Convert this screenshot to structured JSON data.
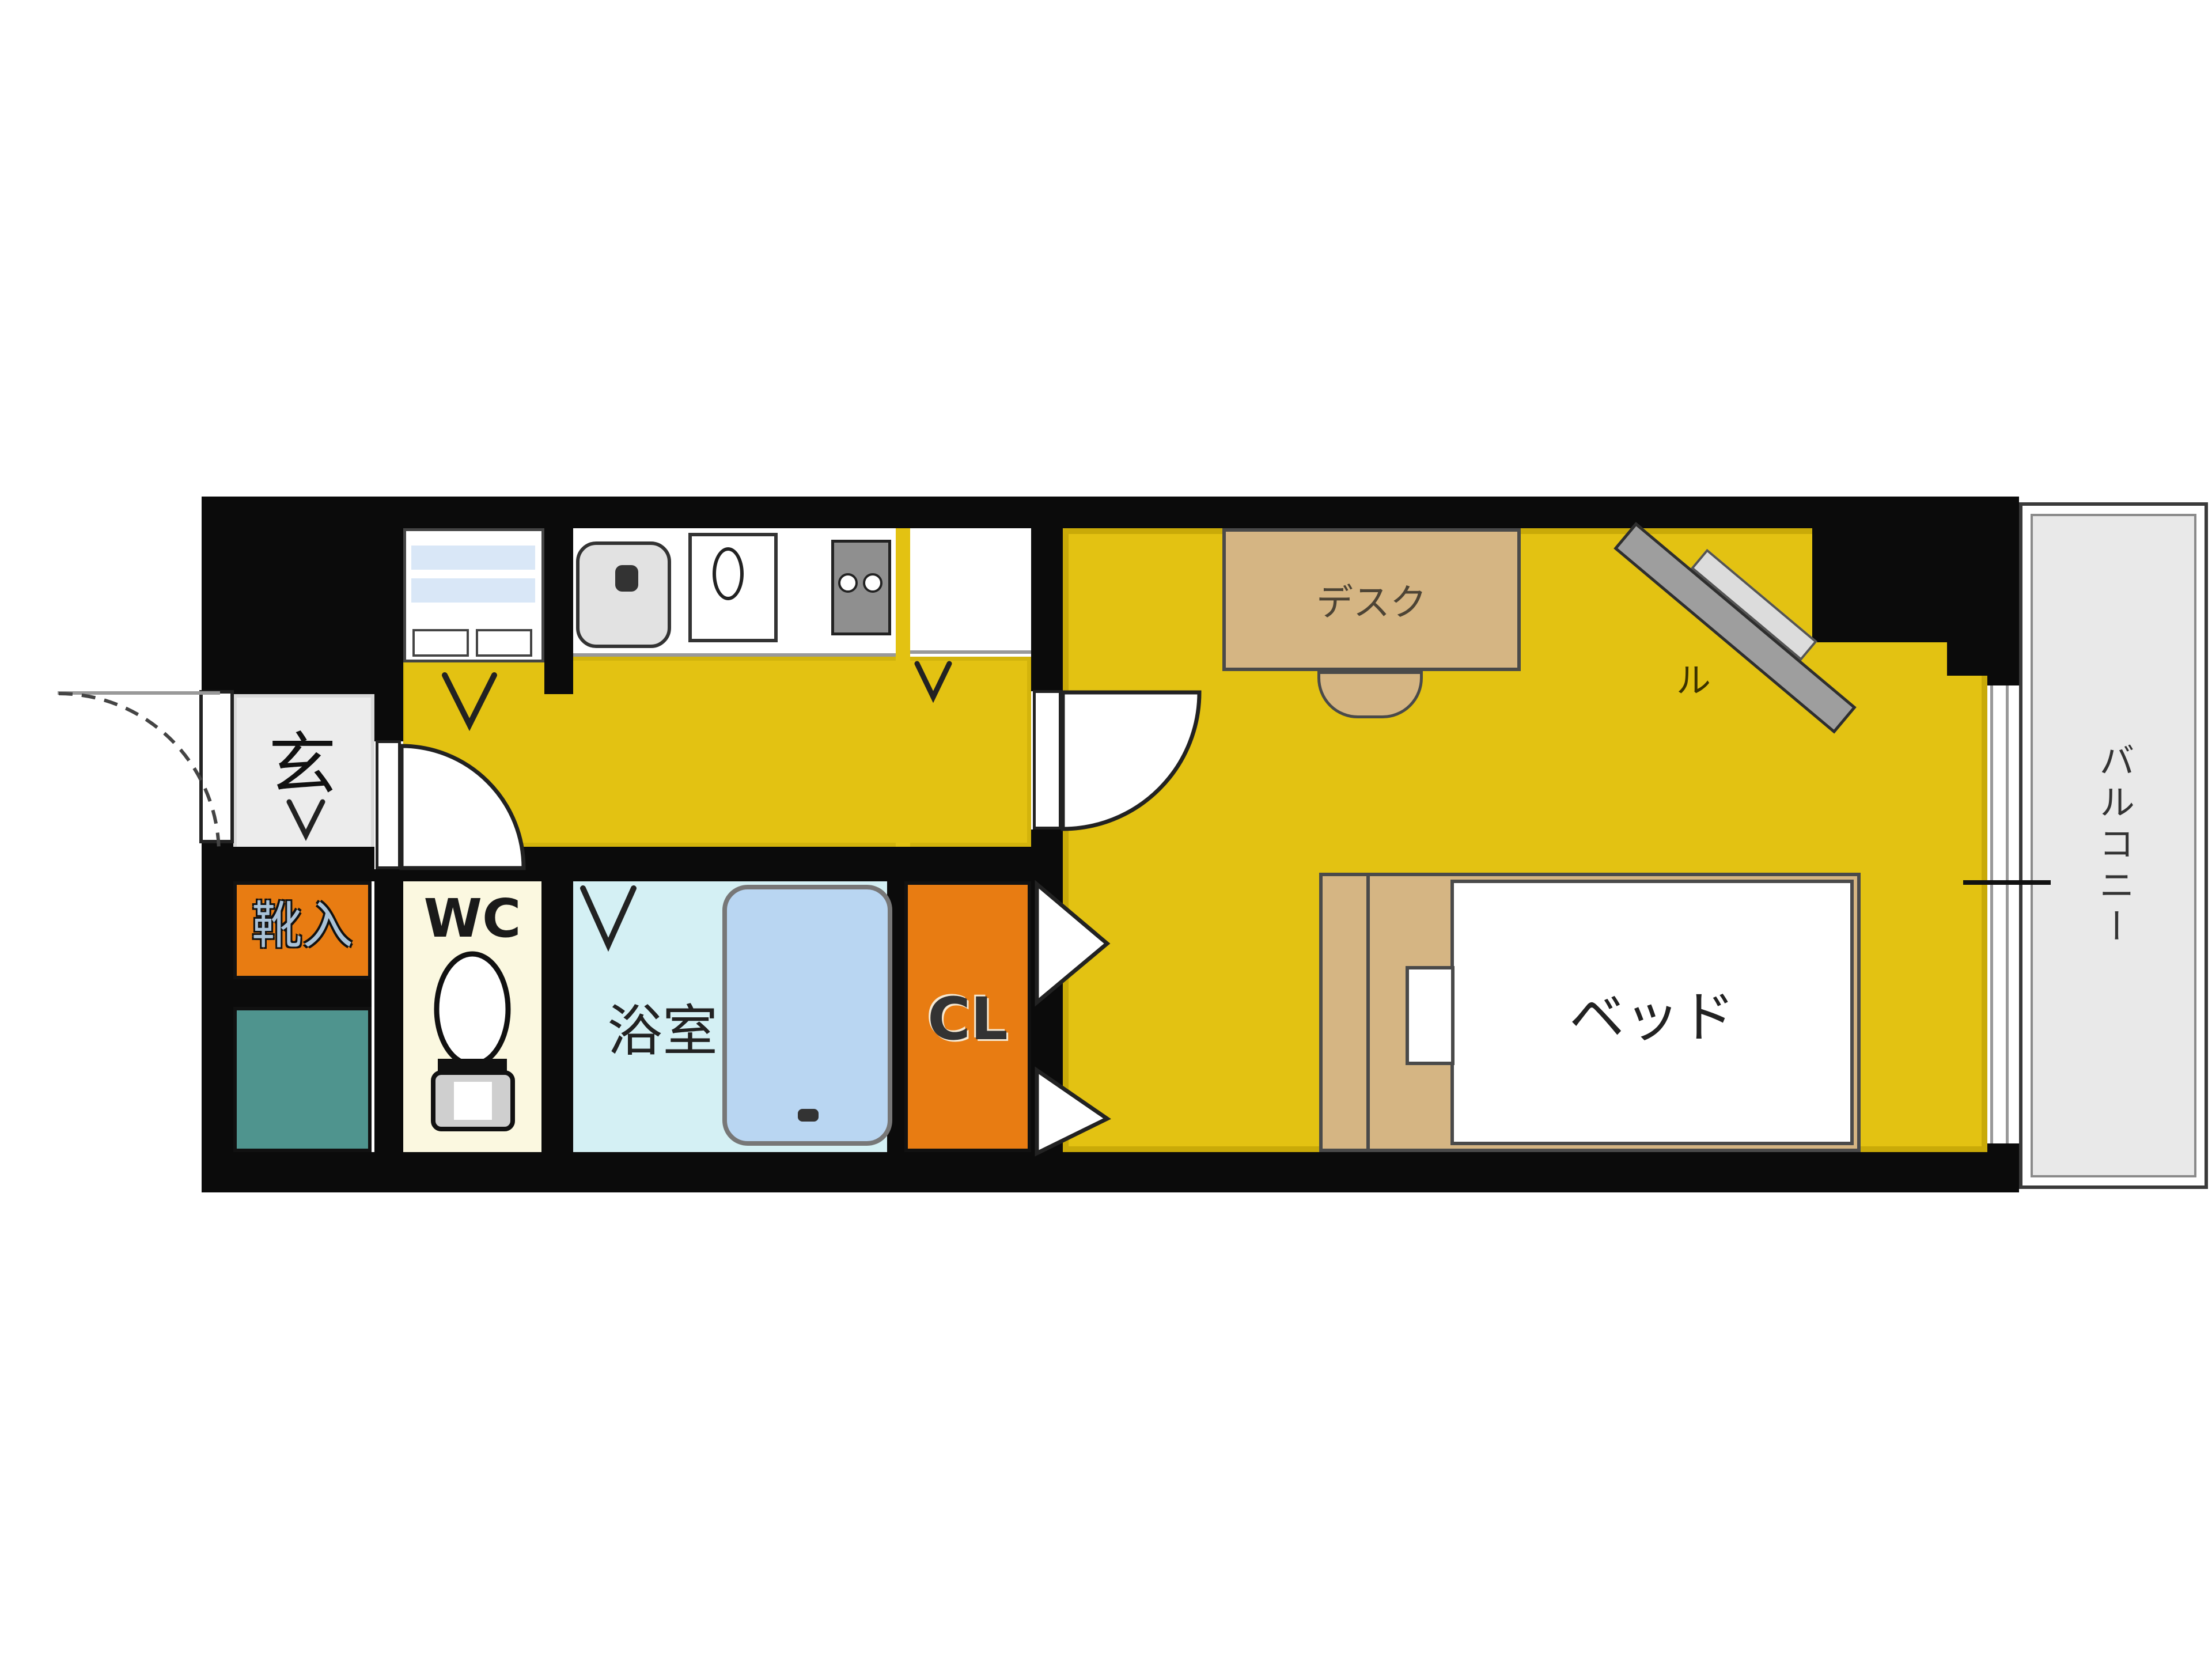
{
  "title": "1K apartment floor plan",
  "rooms": {
    "entrance": {
      "label": "玄"
    },
    "shoe_storage": {
      "label": "靴入",
      "color": "#e87c12"
    },
    "utility_tile": {
      "color": "#4f948e"
    },
    "wc": {
      "label": "WC",
      "color": "#fbf8e0"
    },
    "bathroom": {
      "label": "浴室",
      "color": "#d4f0f4",
      "bathtub_color": "#b9d6f2"
    },
    "closet": {
      "label": "CL",
      "color": "#e87c12"
    },
    "main_room": {
      "color": "#e3c212"
    },
    "balcony": {
      "label": "バルコニー",
      "color": "#e9e9e9"
    }
  },
  "furniture": {
    "desk": {
      "label": "デスク",
      "color": "#d5b583"
    },
    "bed": {
      "label": "ベッド",
      "frame_color": "#d5b583"
    },
    "tv": {
      "label": "ル",
      "color": "#9e9e9e"
    }
  },
  "fixtures": {
    "icons": [
      "washing-machine-space-icon",
      "kitchen-sink-icon",
      "cooktop-icon",
      "grill-burner-icon",
      "refrigerator-space-icon",
      "toilet-icon",
      "bathtub-icon",
      "door-swing-icon",
      "folding-door-icon",
      "door-direction-chevron-icon",
      "window-icon"
    ]
  },
  "colors": {
    "walls": "#0b0b0b",
    "floor_yellow": "#e3c212",
    "entrance_floor": "#ececec",
    "accent_orange": "#e87c12",
    "teal": "#4f948e"
  }
}
